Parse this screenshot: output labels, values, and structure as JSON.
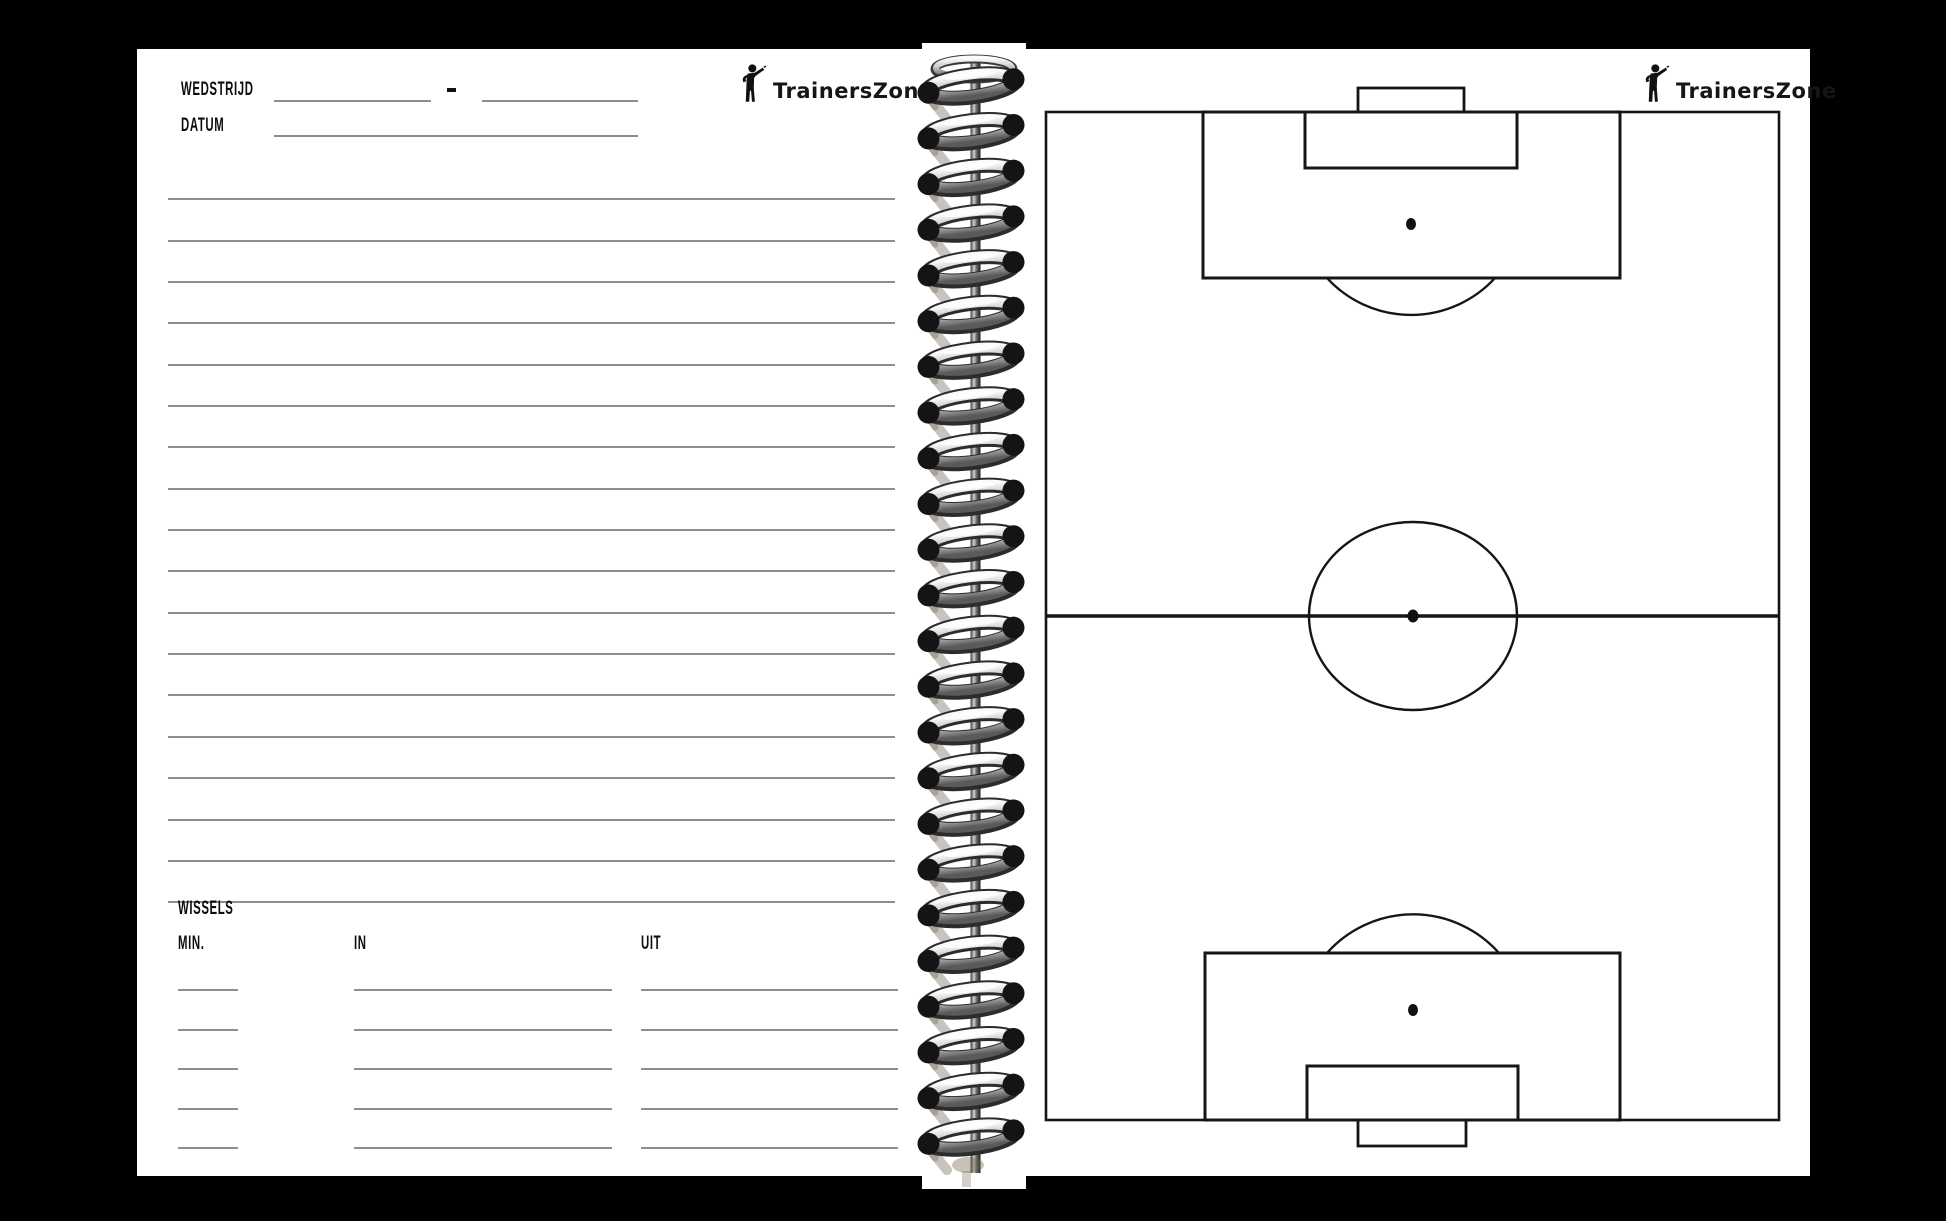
{
  "brand": {
    "name": "TrainersZone"
  },
  "left_page": {
    "wedstrijd_label": "WEDSTRIJD",
    "score_separator": "-",
    "datum_label": "DATUM",
    "notes": {
      "ruled_line_count": 18
    },
    "wissels": {
      "title": "WISSELS",
      "columns": {
        "min": "MIN.",
        "in": "IN",
        "uit": "UIT"
      },
      "row_count": 5
    }
  },
  "right_page": {
    "diagram": "full football pitch, portrait orientation, blank"
  },
  "spiral": {
    "ring_count": 24,
    "first_ring_y": 43,
    "ring_pitch": 45.7
  },
  "colors": {
    "paper": "#ffffff",
    "background": "#000000",
    "rule_line": "#8d8d92",
    "ink": "#0d0d0d",
    "pitch_line": "#151515"
  }
}
